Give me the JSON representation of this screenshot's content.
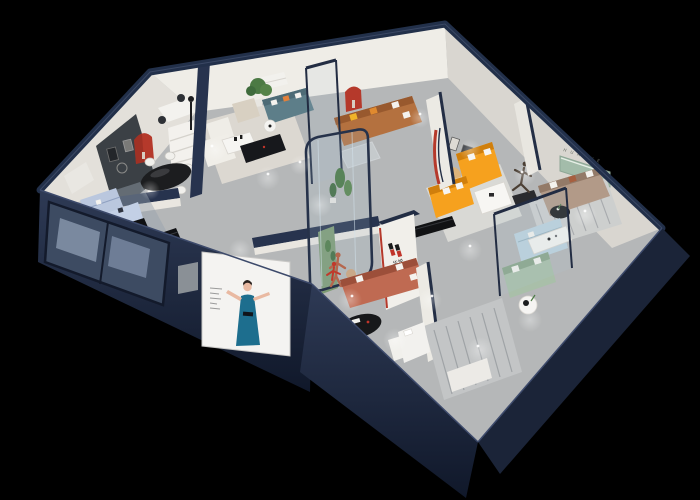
{
  "brand": {
    "logo_text": "华悦",
    "wall_letters": "H U A Y U E",
    "logo_red": "#c0342a",
    "logo_black": "#1a1a1a"
  },
  "palette": {
    "background": "#000000",
    "wall_top_navy": "#232e45",
    "front_wall_navy_dark": "#141c2e",
    "wall_face_white": "#eceae4",
    "wall_face_shadow": "#d8d5cf",
    "floor_gray": "#b5b7b8",
    "accent_red": "#b5392b",
    "orange_sofa": "#f6a11e",
    "caramel_sofa": "#b4713f",
    "teal_sofa": "#5d7e89",
    "powder_blue_sofa": "#bac7de",
    "sage_sofa": "#a9bfa9",
    "pale_blue_sofa": "#bdd2de",
    "taupe_sofa": "#b29a88",
    "terracotta_sofa": "#bf6a52",
    "poster_dress_blue": "#1d6e8e",
    "plant_green": "#46763f",
    "green_panel": "#a3bcaa",
    "glass_tint": "#a9c3d3",
    "black_furniture": "#141518"
  },
  "rooms": [
    {
      "name": "dining-room",
      "items": [
        "black-oval-dining-table",
        "white-dining-chairs",
        "red-arched-niche",
        "dark-media-wall",
        "white-shelf-unit"
      ]
    },
    {
      "name": "blue-sofa-lounge",
      "items": [
        "powder-blue-sectional-sofa",
        "black-coffee-table",
        "black-media-console",
        "framed-artwork"
      ]
    },
    {
      "name": "center-lounge",
      "items": [
        "teal-sofa",
        "cream-armchair",
        "white-armchair",
        "white-coffee-table",
        "black-media-console",
        "potted-tree"
      ]
    },
    {
      "name": "caramel-sofa-area",
      "items": [
        "caramel-leather-sofa",
        "yellow-pillows",
        "glass-coffee-table",
        "red-arched-niche",
        "wall-quote-lines"
      ]
    },
    {
      "name": "orange-sofa-room",
      "items": [
        "orange-l-shaped-sofa",
        "white-coffee-table",
        "curved-red-partition",
        "artwork-frames",
        "warm-floor-lamp"
      ]
    },
    {
      "name": "taupe-sofa-room",
      "items": [
        "taupe-sofa",
        "black-round-coffee-table",
        "green-recessed-panel",
        "runner-sculpture",
        "striped-rug"
      ]
    },
    {
      "name": "glass-sofa-room",
      "items": [
        "sage-green-sofa",
        "pale-blue-sectional",
        "white-coffee-table",
        "glass-partition"
      ]
    },
    {
      "name": "bedroom-corner",
      "items": [
        "white-bed",
        "white-bench",
        "round-side-table",
        "striped-rug"
      ]
    },
    {
      "name": "atrium-corridor",
      "items": [
        "glass-plant-case",
        "green-plants",
        "terracotta-figure-sculpture",
        "side-table"
      ]
    },
    {
      "name": "front-showroom",
      "items": [
        "terracotta-sofa",
        "black-oval-coffee-table",
        "white-ottoman",
        "red-figure-sculpture",
        "wood-stool",
        "brand-logo-wall"
      ]
    }
  ],
  "facade": {
    "poster": "woman-in-blue-dress-poster",
    "windows": "navy-framed-glass-panes",
    "ac_unit": "gray-wall-box"
  }
}
